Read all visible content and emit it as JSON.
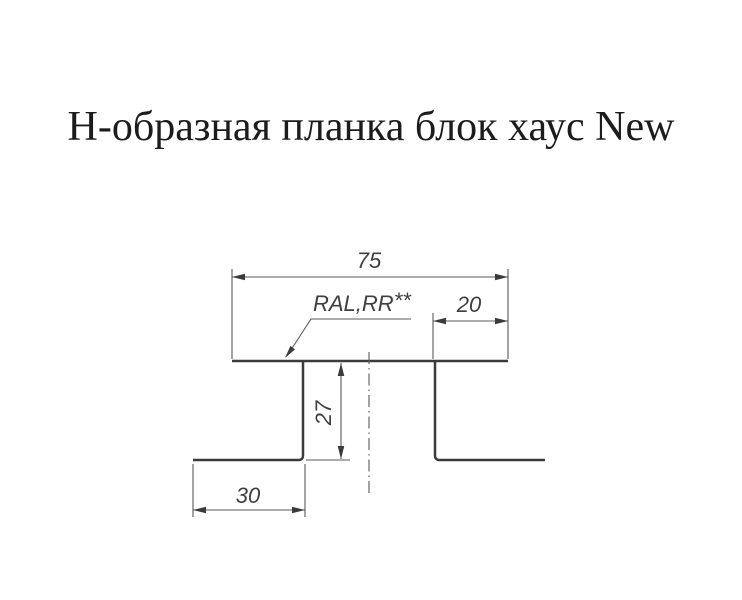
{
  "title": "Н-образная планка блок хаус New",
  "drawing": {
    "coating_label": {
      "text": "RAL,RR",
      "stars": "**"
    },
    "dimensions": {
      "overall_top_width": "75",
      "right_top_flat": "20",
      "web_height": "27",
      "bottom_flange_width": "30"
    }
  },
  "colors": {
    "background": "#ffffff",
    "title_text": "#1c1c1c",
    "profile_line": "#3b3b3b",
    "dimension_line": "#5a5a5a",
    "dimension_text": "#3f3f3f"
  }
}
